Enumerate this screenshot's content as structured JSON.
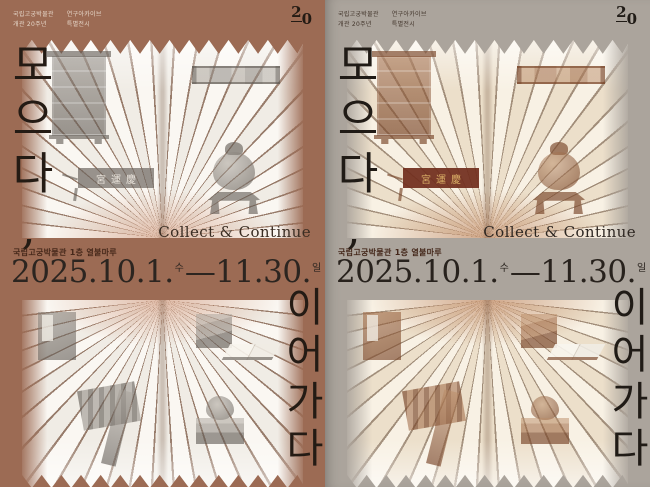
{
  "colors": {
    "left_poster_background": "#9c6b54",
    "right_poster_background": "#aba49c",
    "title_ink": "#241b14",
    "date_ink": "#2c2520",
    "venue_ink": "#47291b",
    "page_white": "#faf7f2",
    "page_cream": "#f8f1e4",
    "artifact_gray": "#8d8780",
    "artifact_sepia": "#9a6848",
    "signboard_red": "#702c1c",
    "signboard_gold": "#d9ae66"
  },
  "posters": [
    {
      "id": "terracotta-variant",
      "background": "#9c6b54"
    },
    {
      "id": "greige-variant",
      "background": "#aba49c"
    }
  ],
  "poster": {
    "meta_block1_line1": "국립고궁박물관",
    "meta_block1_line2": "개관 20주년",
    "meta_block2_line1": "연구아카이브",
    "meta_block2_line2": "특별전시",
    "logo_digit_top": "2",
    "logo_digit_bottom": "0",
    "title_top_vertical": "모으다,",
    "title_bottom_vertical": "이어가다",
    "subtitle_english": "Collect & Continue",
    "venue": "국립고궁박물관 1층 열불마루",
    "date_start": "2025.10.1.",
    "date_start_day": "수",
    "date_separator": "—",
    "date_end": "11.30.",
    "date_end_day": "일",
    "signboard_text": "宮運慶",
    "artifacts_top": [
      "wooden-cabinet",
      "horizontal-plaque",
      "palace-signboard",
      "bronze-incense-burner"
    ],
    "artifacts_bottom": [
      "royal-book-cover",
      "book-box-with-open-book",
      "folded-textile",
      "royal-seal"
    ]
  }
}
